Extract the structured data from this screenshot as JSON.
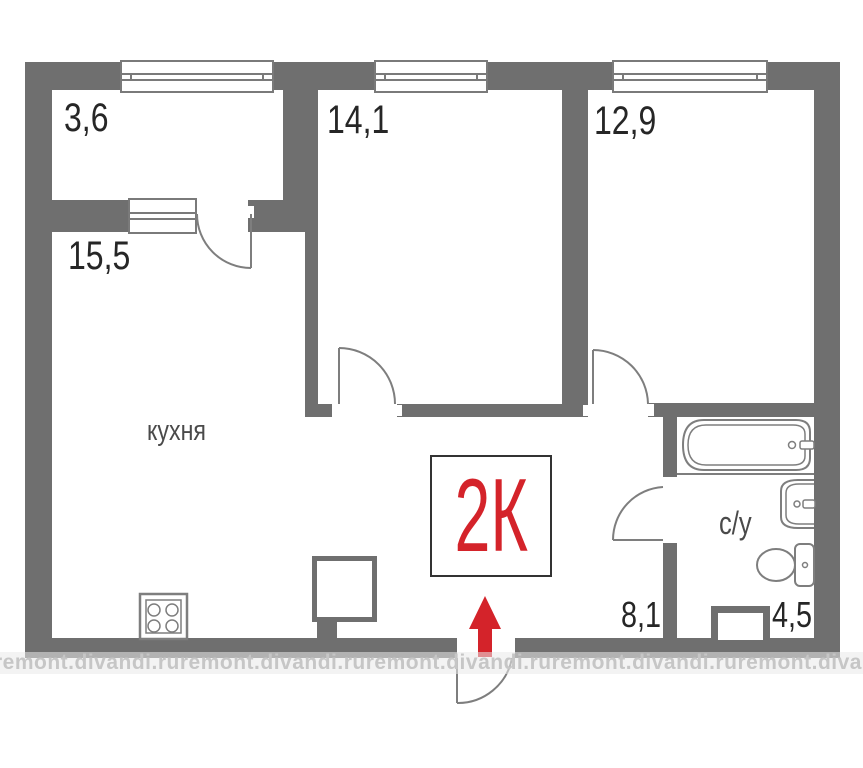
{
  "meta": {
    "type": "apartment-floor-plan",
    "plan_label": "2К"
  },
  "watermark": {
    "text": "remont.divandi.ru"
  },
  "rooms": [
    {
      "key": "balcony",
      "area": "3,6"
    },
    {
      "key": "room-14",
      "area": "14,1"
    },
    {
      "key": "room-12",
      "area": "12,9"
    },
    {
      "key": "kitchen",
      "area": "15,5",
      "name": "кухня"
    },
    {
      "key": "hallway",
      "area": "8,1"
    },
    {
      "key": "bathroom",
      "area": "4,5",
      "name": "с/у"
    }
  ],
  "colors": {
    "wall": "#6f6f6f",
    "fixture_line": "#7e7e7e",
    "text": "#262626",
    "accent_red": "#d4232a",
    "watermark_text": "#c6c6c6"
  }
}
